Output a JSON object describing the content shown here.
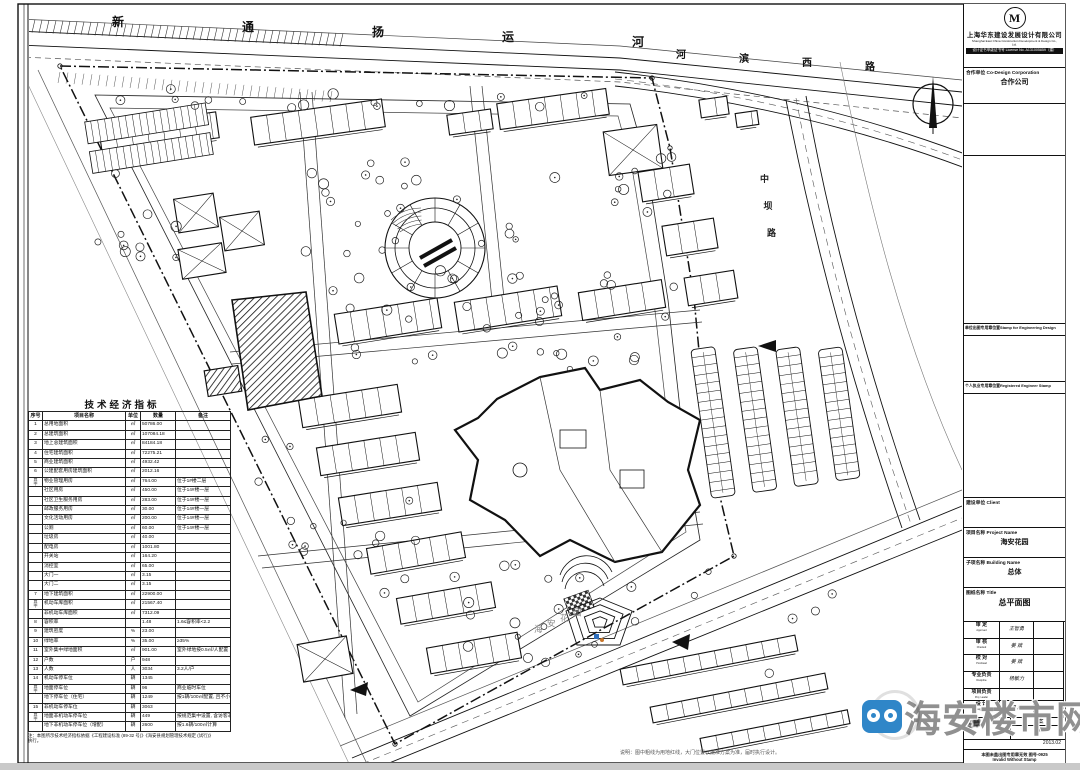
{
  "title_block": {
    "logo_letter": "M",
    "company_cn": "上海华东建设发展设计有限公司",
    "company_en1": "Shanghai East China Construction Development & Design Co., Ltd.",
    "company_en2": "设计证书甲级证书号 License No. A131005859（建）",
    "partner_label": "合作单位 Co-Design Corporation",
    "partner_name": "合作公司",
    "stamp_unit_label": "单位出图专用章位置Stamp for Engineering Design",
    "stamp_personal_label": "个人执业专用章位置Registered Engineer Stamp",
    "client_label": "建设单位 Client",
    "project_label": "项目名称 Project Name",
    "project_name": "海安花园",
    "subproject_label": "子项名称 Building Name",
    "subproject_name": "总体",
    "sheet_label": "图纸名称 Title",
    "sheet_name": "总平面图",
    "sign_rows": [
      {
        "label": "审 定",
        "en": "Approved",
        "name": "王智勇"
      },
      {
        "label": "审 核",
        "en": "Checked",
        "name": "姜 斌"
      },
      {
        "label": "校 对",
        "en": "Proofread",
        "name": "姜 斌"
      },
      {
        "label": "专业负责",
        "en": "Discipline",
        "name": "杨敏力"
      },
      {
        "label": "项目负责",
        "en": "Proj. Leader",
        "name": ""
      },
      {
        "label": "设 计",
        "en": "Designed By",
        "name": "周 静"
      }
    ],
    "stamp_scribble": "签章",
    "stage": "方案",
    "edition": "初稿",
    "date": "2013.02",
    "invalid_cn": "本图未盖出图专用章无效 图号-0925",
    "invalid_en": "Invalid Without Stamp"
  },
  "indicator_table": {
    "title": "技术经济指标",
    "headers": [
      "序号",
      "项目名称",
      "单位",
      "数量",
      "备注"
    ],
    "rows": [
      [
        "1",
        "总用地面积",
        "㎡",
        "50786.00",
        ""
      ],
      [
        "2",
        "总建筑面积",
        "㎡",
        "107084.18",
        ""
      ],
      [
        "3",
        "地上总建筑面积",
        "㎡",
        "84184.18",
        ""
      ],
      [
        "4",
        "住宅建筑面积",
        "㎡",
        "72275.21",
        ""
      ],
      [
        "5",
        "商业建筑面积",
        "㎡",
        "4932.42",
        ""
      ],
      [
        "6",
        "公建配套用房建筑面积",
        "㎡",
        "2012.16",
        ""
      ],
      [
        "其中",
        "物业管理用房",
        "㎡",
        "764.00",
        "位于1#楼二层"
      ],
      [
        "",
        "社区用房",
        "㎡",
        "450.00",
        "位于14#楼一层"
      ],
      [
        "",
        "社区卫生服务用房",
        "㎡",
        "283.00",
        "位于14#楼一层"
      ],
      [
        "",
        "邮政服务用房",
        "㎡",
        "30.00",
        "位于14#楼一层"
      ],
      [
        "",
        "文化活动用房",
        "㎡",
        "200.00",
        "位于14#楼一层"
      ],
      [
        "",
        "公厕",
        "㎡",
        "60.00",
        "位于14#楼一层"
      ],
      [
        "",
        "垃圾房",
        "㎡",
        "40.00",
        ""
      ],
      [
        "",
        "配电房",
        "㎡",
        "1001.80",
        ""
      ],
      [
        "",
        "开关站",
        "㎡",
        "164.20",
        ""
      ],
      [
        "",
        "消控室",
        "㎡",
        "65.00",
        ""
      ],
      [
        "",
        "大门一",
        "㎡",
        "3.15",
        ""
      ],
      [
        "",
        "大门二",
        "㎡",
        "3.15",
        ""
      ],
      [
        "7",
        "地下建筑面积",
        "㎡",
        "22900.00",
        ""
      ],
      [
        "其中",
        "机动车库面积",
        "㎡",
        "21567.40",
        ""
      ],
      [
        "",
        "非机动车库面积",
        "㎡",
        "7312.09",
        ""
      ],
      [
        "8",
        "容积率",
        "",
        "1.48",
        "1.6≤容积率<2.2"
      ],
      [
        "9",
        "建筑密度",
        "%",
        "23.00",
        ""
      ],
      [
        "10",
        "绿地率",
        "%",
        "35.00",
        "≥35%"
      ],
      [
        "11",
        "室外集中绿地面积",
        "㎡",
        "901.00",
        "室外绿地按0.5㎡/人配置"
      ],
      [
        "12",
        "户数",
        "户",
        "948",
        ""
      ],
      [
        "13",
        "人数",
        "人",
        "3034",
        "3.2人/户"
      ],
      [
        "14",
        "机动车停车位",
        "辆",
        "1345",
        ""
      ],
      [
        "其中",
        "地面停车位",
        "辆",
        "96",
        "商业临时车位"
      ],
      [
        "",
        "地下停车位（住宅）",
        "辆",
        "1249",
        "按1辆/100㎡配置, 且不小于0.8辆/户"
      ],
      [
        "15",
        "非机动车停车位",
        "辆",
        "3063",
        ""
      ],
      [
        "其中",
        "地面非机动车停车位",
        "辆",
        "449",
        "按规范集中设置, 含访客非机动车位"
      ],
      [
        "",
        "地下非机动车停车位（增配）",
        "辆",
        "2600",
        "按1.6辆/100㎡计算"
      ]
    ],
    "footnote": "注：本图所示技术经济指标依据《工程建设标准 (89-32 号)》《海安县规划管理技术规定 (试行)》执行。"
  },
  "plan": {
    "canal_label": "新通扬运河",
    "road_top_label": "河滨西路",
    "road_right_label": "中坝路",
    "adjacent_label": "海安花园",
    "plan_note": "说明：图中粗线为用地红线，大门位置以批准方案为准，届时执行设计。"
  },
  "watermark": {
    "text": "海安楼市网",
    "color": "#2f86c8"
  }
}
